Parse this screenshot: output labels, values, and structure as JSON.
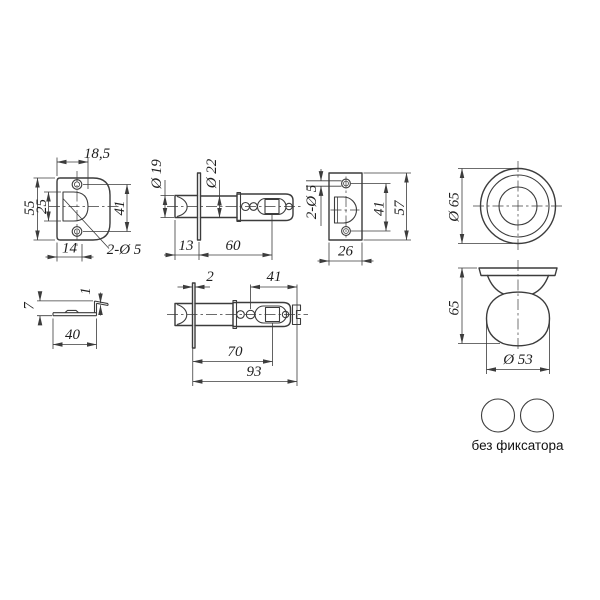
{
  "colors": {
    "line": "#3c3c3c",
    "text": "#1f1f1f",
    "background": "#ffffff"
  },
  "views": {
    "faceplate_front": {
      "dims": {
        "top_width": "18,5",
        "height": "55",
        "cutout_height": "25",
        "hole_spacing": "41",
        "bottom_width": "14",
        "holes": "2-Ø 5"
      }
    },
    "latch_side_short": {
      "dims": {
        "head_diameter": "Ø 19",
        "barrel_diameter": "Ø 22",
        "head_length": "13",
        "barrel_length": "60"
      }
    },
    "strike_plate": {
      "dims": {
        "holes": "2-Ø 5",
        "hole_spacing": "41",
        "height": "57",
        "width": "26"
      }
    },
    "knob_front": {
      "dims": {
        "diameter": "Ø 65"
      }
    },
    "knob_side": {
      "dims": {
        "height": "65",
        "ball_diameter": "Ø 53"
      }
    },
    "faceplate_edge": {
      "dims": {
        "height": "7",
        "lip_thickness": "1",
        "width": "40"
      }
    },
    "latch_side_full": {
      "dims": {
        "plate_thickness": "2",
        "rear_spacing": "41",
        "spindle_distance": "70",
        "total_length": "93"
      }
    },
    "variant": {
      "caption": "без фиксатора"
    }
  }
}
